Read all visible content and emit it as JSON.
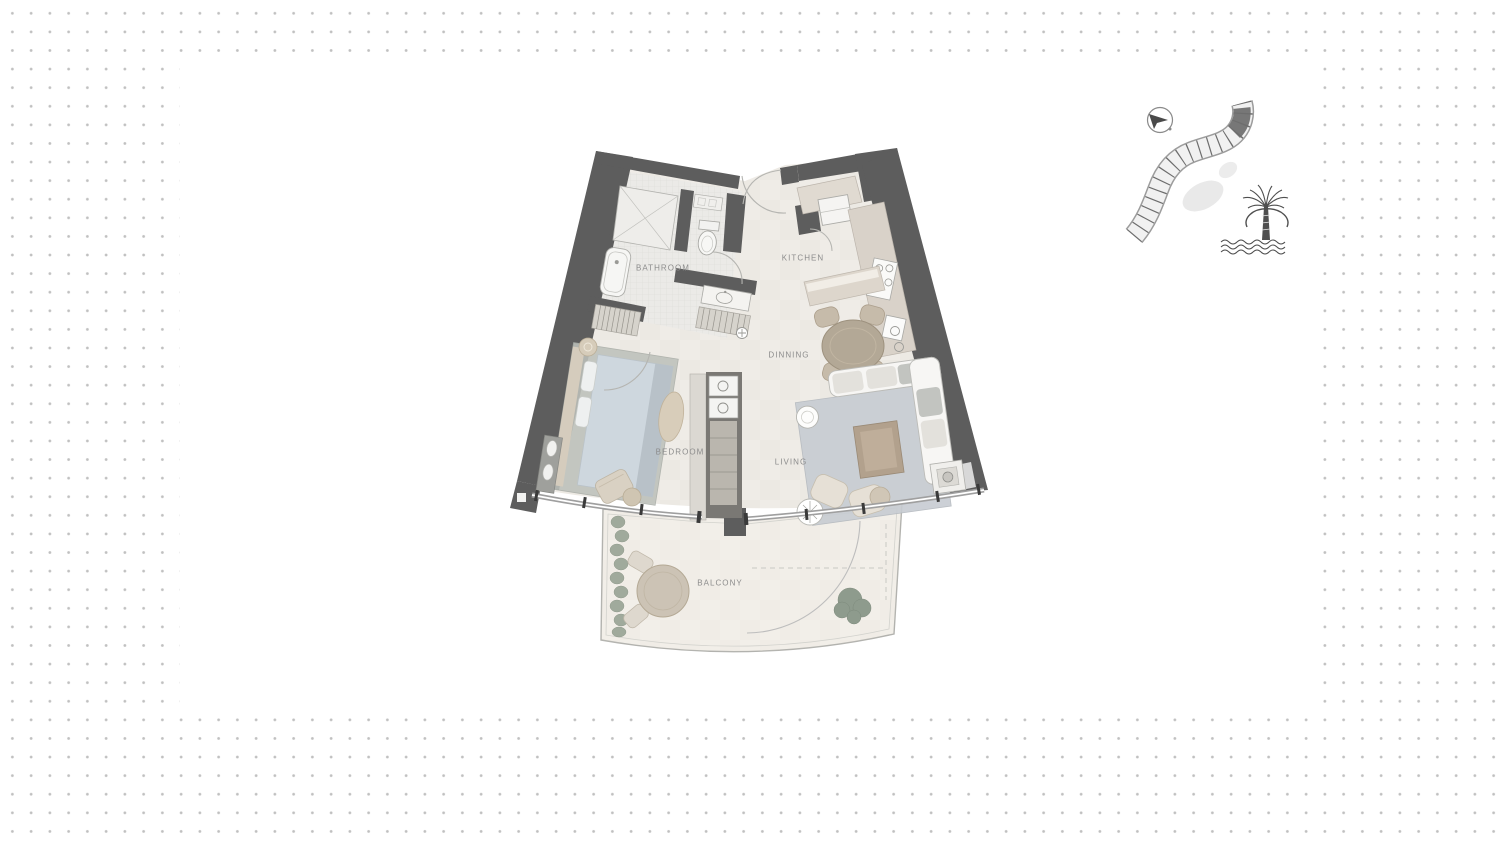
{
  "page": {
    "background_color": "#ffffff",
    "dot_color": "#c0c0c0",
    "content_panel": "floor-plan image on white panel"
  },
  "floorplan": {
    "rooms": [
      {
        "id": "bathroom",
        "label": "BATHROOM"
      },
      {
        "id": "kitchen",
        "label": "KITCHEN"
      },
      {
        "id": "dinning",
        "label": "DINNING"
      },
      {
        "id": "bedroom",
        "label": "BEDROOM"
      },
      {
        "id": "living",
        "label": "LIVING"
      },
      {
        "id": "balcony",
        "label": "BALCONY"
      }
    ],
    "colors": {
      "wall": "#5d5d5d",
      "floor": "#efece7",
      "bathroom_tile": "#ebeae7",
      "counter": "#d9d2c9",
      "rug": "#c7ccd2",
      "mattress": "#ced7de",
      "wood": "#b3a896",
      "greenery": "#93a093",
      "label_text": "#8c8c8c",
      "outline": "#b0b0b0"
    }
  },
  "sitemap": {
    "icons": [
      {
        "name": "compass-icon"
      },
      {
        "name": "building-key-plan"
      },
      {
        "name": "palm-jumeirah-logo"
      }
    ]
  }
}
